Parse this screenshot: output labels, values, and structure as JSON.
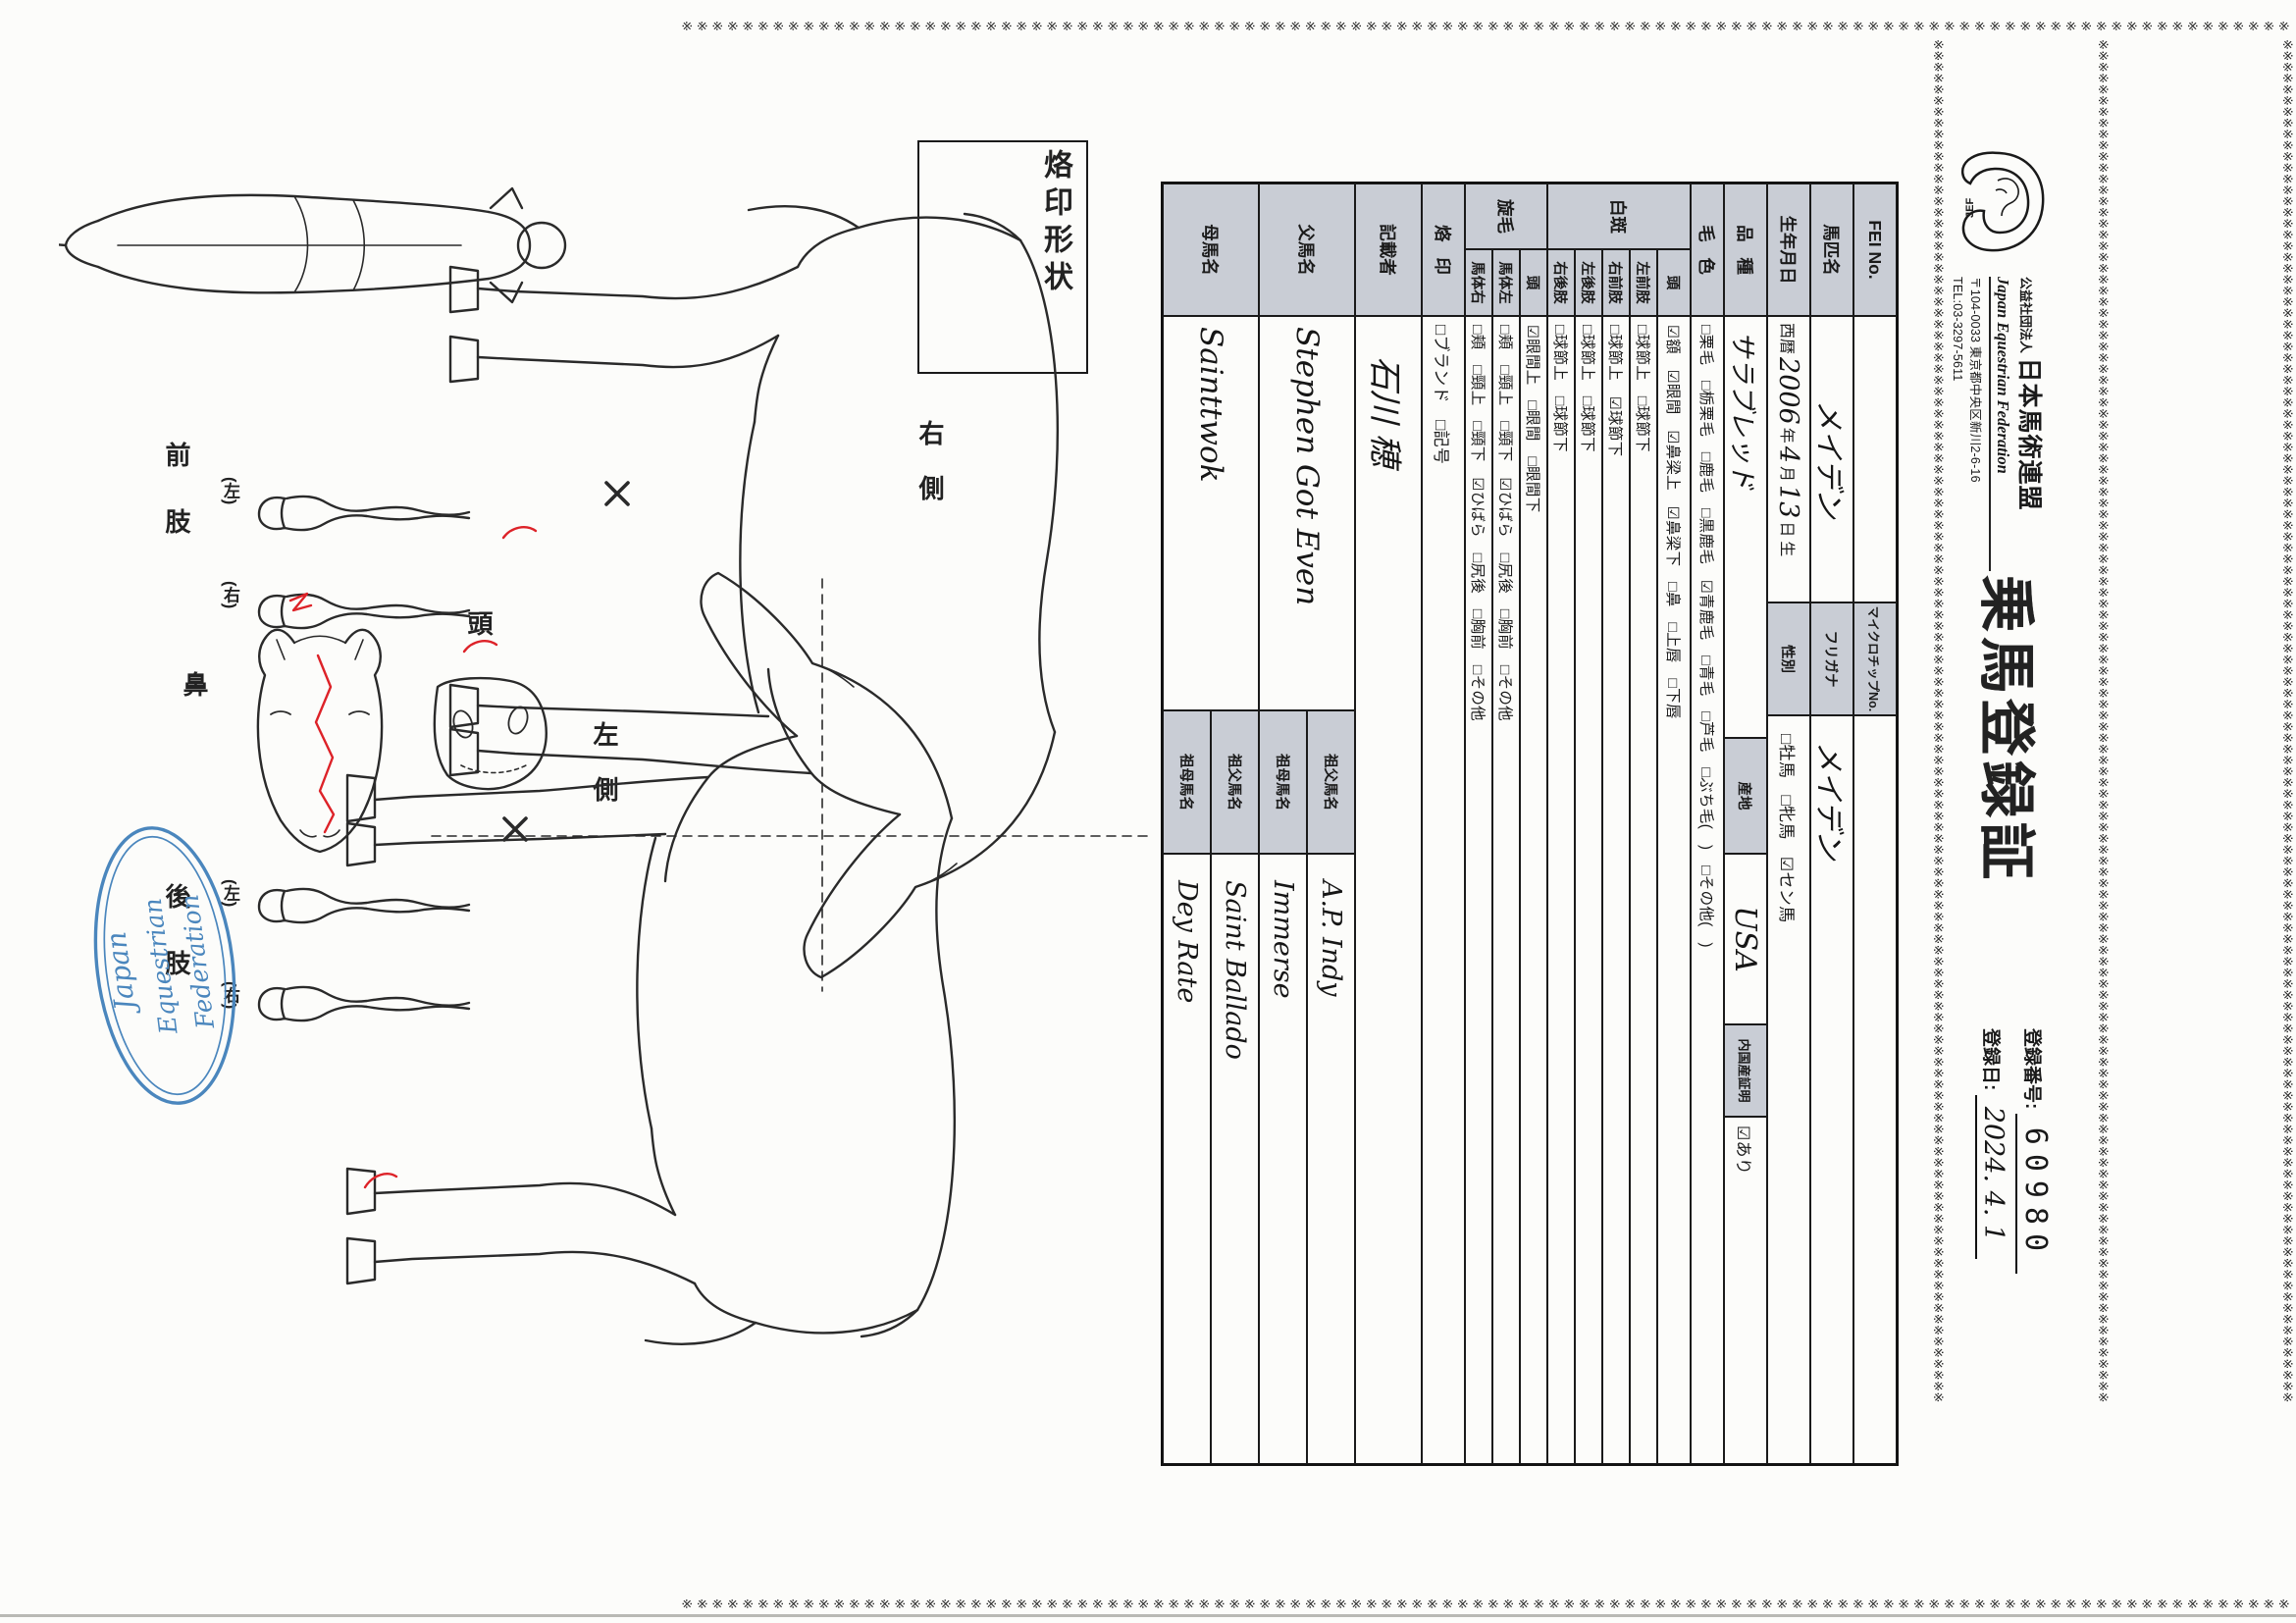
{
  "header": {
    "org_small": "公益社団法人",
    "org_name": "日本馬術連盟",
    "org_en": "Japan Equestrian Federation",
    "address": "〒104-0033 東京都中央区新川2-6-16",
    "tel": "TEL:03-3297-5611",
    "logo_text": "JEF",
    "title": "乗馬登録証",
    "reg_no_label": "登録番号:",
    "reg_no": "60980",
    "reg_date_label": "登録日:",
    "reg_date": "2024. 4. 1"
  },
  "table": {
    "fei": {
      "label": "FEI No.",
      "mid": "マイクロチップNo.",
      "value": "",
      "mid_value": ""
    },
    "name": {
      "label": "馬匹名",
      "value": "メイデン",
      "mid": "フリガナ",
      "mid_value": "メイデン"
    },
    "birth": {
      "label": "生年月日",
      "era": "西暦",
      "year": "2006",
      "y_unit": "年",
      "month": "4",
      "m_unit": "月",
      "day": "13",
      "d_unit": "日",
      "suffix": "生",
      "mid": "性別",
      "sex_options": "□牡馬　□牝馬　☑セン馬"
    },
    "breed": {
      "label": "品種",
      "value": "サラブレッド",
      "mid": "産地",
      "origin": "USA",
      "domestic_label": "内国産証明",
      "domestic_value": "☑あり"
    },
    "coat": {
      "label": "毛色",
      "options": "□栗毛　□栃栗毛　□鹿毛　□黒鹿毛　☑青鹿毛　□青毛　□芦毛　□ぶち毛(　)　□その他(　)"
    },
    "hakuhan": {
      "group": "白斑",
      "rows": [
        {
          "label": "頭",
          "options": "☑額　☑眼間　☑鼻梁上　☑鼻梁下　□鼻　□上唇　□下唇"
        },
        {
          "label": "左前肢",
          "options": "□球節上　□球節下"
        },
        {
          "label": "右前肢",
          "options": "□球節上　☑球節下"
        },
        {
          "label": "左後肢",
          "options": "□球節上　□球節下"
        },
        {
          "label": "右後肢",
          "options": "□球節上　□球節下"
        }
      ]
    },
    "senmo": {
      "group": "旋毛",
      "rows": [
        {
          "label": "頭",
          "options": "☑眼間上　□眼間　□眼間下"
        },
        {
          "label": "馬体左",
          "options": "□頬　□頸上　□頸下　☑ひばら　□尻後　□胸前　□その他"
        },
        {
          "label": "馬体右",
          "options": "□頬　□頸上　□頸下　☑ひばら　□尻後　□胸前　□その他"
        }
      ]
    },
    "brand": {
      "label": "烙印",
      "options": "□ブランド　□記号"
    },
    "recorder": {
      "label": "記載者",
      "value": "石川 穂"
    },
    "sire": {
      "label": "父馬名",
      "value": "Stephen Got Even",
      "gs_label": "祖父馬名",
      "gs_value": "A.P. Indy",
      "gd_label": "祖母馬名",
      "gd_value": "Immerse"
    },
    "dam": {
      "label": "母馬名",
      "value": "Sainttwok",
      "gs_label": "祖父馬名",
      "gs_value": "Saint Ballado",
      "gd_label": "祖母馬名",
      "gd_value": "Dey Rate"
    }
  },
  "diagram": {
    "brand_shape": "烙印形状",
    "right_side": "右側",
    "left_side": "左側",
    "head": "頭",
    "nose": "鼻",
    "front_legs": "前肢",
    "hind_legs": "後肢",
    "paren_left": "(左)",
    "paren_right": "(右)"
  },
  "stamp": {
    "line1": "Japan",
    "line2": "Equestrian",
    "line3": "Federation",
    "color": "#4a86bd"
  }
}
